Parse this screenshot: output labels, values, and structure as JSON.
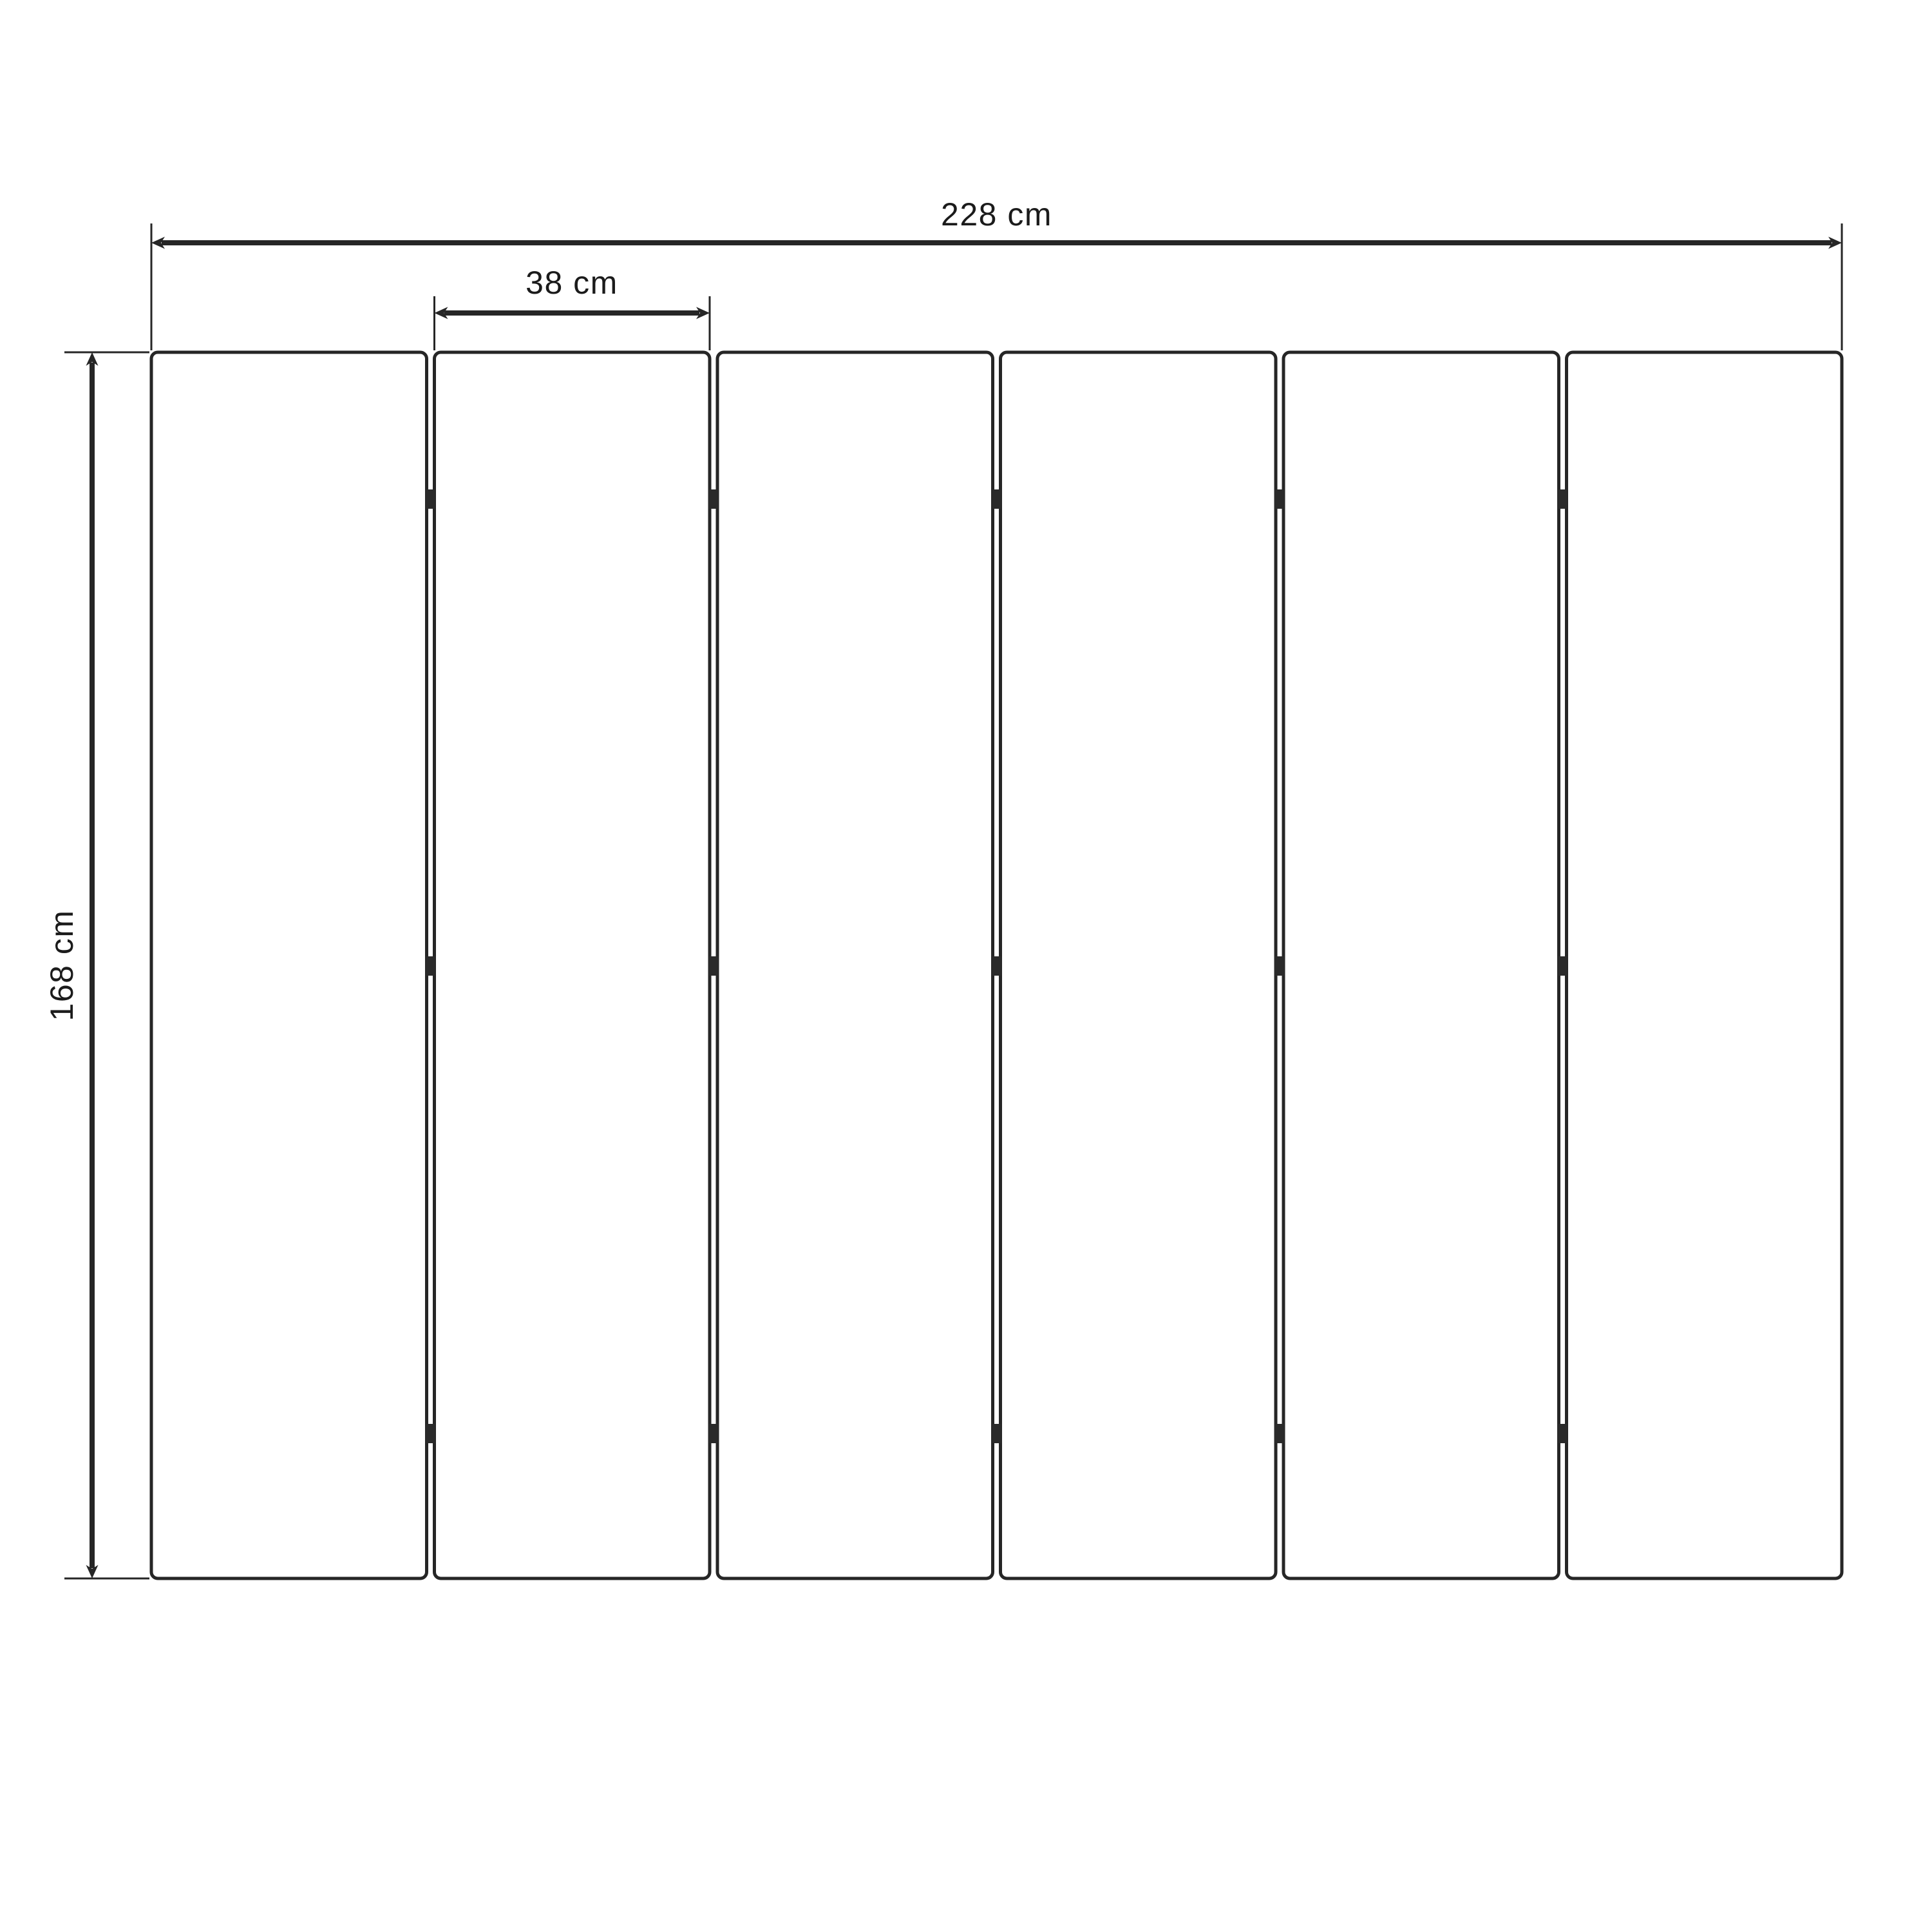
{
  "diagram": {
    "background_color": "#ffffff",
    "line_color": "#262626",
    "text_color": "#1b1b1b",
    "labels": {
      "total_width": "228 cm",
      "panel_width": "38 cm",
      "height": "168 cm"
    },
    "panel_count": 6,
    "hinges_per_gap": 3
  }
}
